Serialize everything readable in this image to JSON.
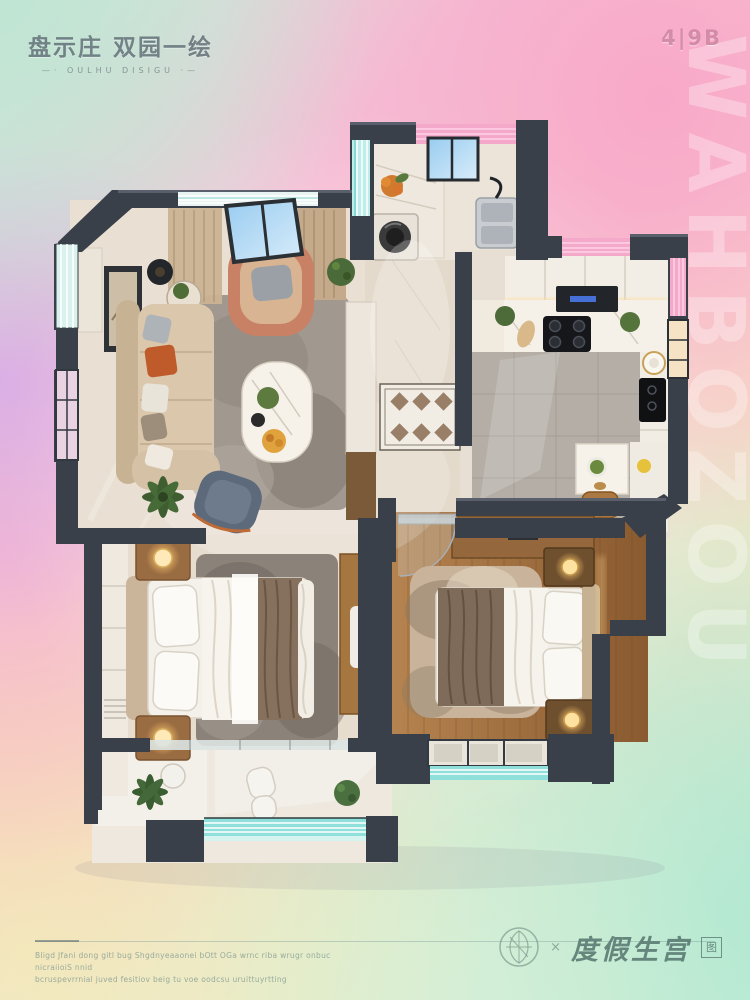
{
  "header": {
    "title": "盘示庄 双园一绘",
    "subtitle": "—· OULHU DISIGU ·—",
    "unit_code": "4|9B"
  },
  "watermark": {
    "text": "WAHBOZOU"
  },
  "floor_plan": {
    "type": "top-down-3d-render",
    "rooms": [
      {
        "name": "living-room",
        "furniture": [
          "l-shaped-sofa",
          "armchair",
          "coffee-table",
          "side-table",
          "floor-lamp",
          "area-rug",
          "accent-chair",
          "potted-palm",
          "wall-art",
          "curtains",
          "sky-window",
          "marble-console"
        ]
      },
      {
        "name": "laundry-room",
        "furniture": [
          "washing-machine",
          "marble-counter",
          "fruit-basket",
          "double-sink",
          "window"
        ]
      },
      {
        "name": "kitchen",
        "furniture": [
          "upper-cabinets",
          "range-hood",
          "gas-cooktop",
          "marble-counter",
          "induction-panel",
          "round-sink",
          "dining-table",
          "salad-plate",
          "stool",
          "potted-plants"
        ]
      },
      {
        "name": "entry-hall",
        "furniture": [
          "diamond-mosaic-floor",
          "glass-door"
        ]
      },
      {
        "name": "bedroom-main",
        "furniture": [
          "double-bed",
          "nightstand-lamps",
          "wardrobe-panels",
          "desk",
          "area-rug"
        ]
      },
      {
        "name": "bedroom-second",
        "furniture": [
          "double-bed",
          "nightstand-lamps",
          "wardrobe-desk",
          "shag-rug",
          "glass-door",
          "window"
        ]
      },
      {
        "name": "balcony",
        "furniture": [
          "round-table",
          "lounge-chair",
          "potted-plants",
          "teal-glass-railing"
        ]
      }
    ]
  },
  "footer": {
    "disclaimer_line1": "Bligd Jfani dong gitl bug Shgdnyeaaonei bOtt OGa wrnc riba wrugr onbuc nicraiioiS nnid",
    "disclaimer_line2": "bcruspevrrnial juved fesitiov beig tu voe oodcsu uruittuyrtting"
  },
  "logo": {
    "emblem_icon": "circular-leaf-emblem",
    "separator": "×",
    "brand_text": "度假生宫",
    "seal_text": "图"
  },
  "palette": {
    "wall": "#394049",
    "background_pink": "#f6b9d3",
    "background_mint": "#bfe4d2",
    "background_lavender": "#d9b2e3",
    "background_peach": "#f8d9b8",
    "background_yellow": "#f2ecbc",
    "background_aqua": "#a8e6cf",
    "glass_teal": "#8fe0da",
    "glass_pink": "#f4a9cb",
    "floor_marble": "#e9e0d3",
    "floor_wood": "#a9774a",
    "sofa_beige": "#d8c3a6",
    "accent_orange": "#bf5a2b",
    "lamp_glow": "#ffd98f"
  }
}
